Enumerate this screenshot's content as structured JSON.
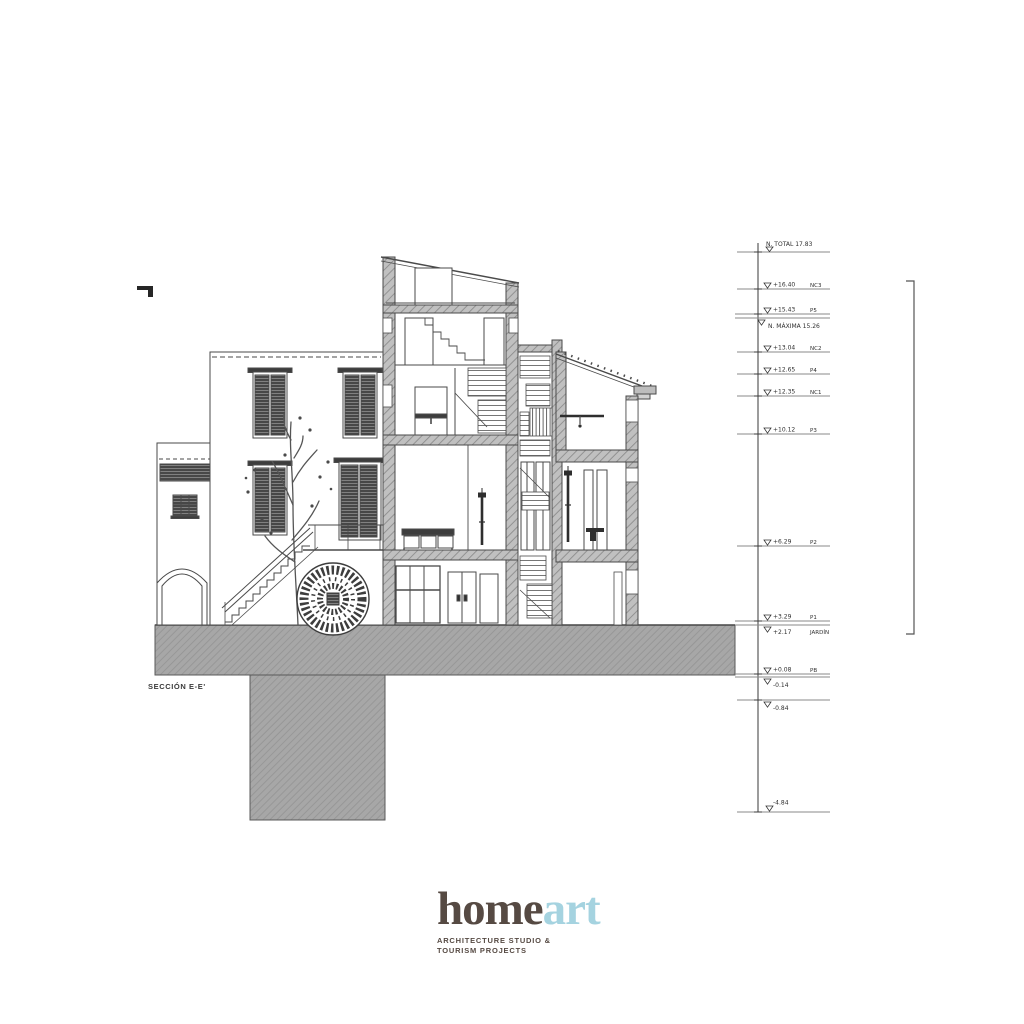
{
  "drawing": {
    "section_label": "SECCIÓN E-E'"
  },
  "levels": {
    "total_label": "N. TOTAL 17.83",
    "maxima_label": "N. MÁXIMA 15.26",
    "items": [
      {
        "elev": "+16.40",
        "tag": "NC3"
      },
      {
        "elev": "+15.43",
        "tag": "P5"
      },
      {
        "elev": "+13.04",
        "tag": "NC2"
      },
      {
        "elev": "+12.65",
        "tag": "P4"
      },
      {
        "elev": "+12.35",
        "tag": "NC1"
      },
      {
        "elev": "+10.12",
        "tag": "P3"
      },
      {
        "elev": "+6.29",
        "tag": "P2"
      },
      {
        "elev": "+3.29",
        "tag": "P1"
      },
      {
        "elev": "+2.17",
        "tag": "JARDÍN"
      },
      {
        "elev": "+0.08",
        "tag": "PB"
      },
      {
        "elev": "-0.14",
        "tag": ""
      },
      {
        "elev": "-0.84",
        "tag": ""
      },
      {
        "elev": "-4.84",
        "tag": ""
      }
    ]
  },
  "logo": {
    "word_primary": "home",
    "word_accent": "art",
    "subtitle_line1": "ARCHITECTURE STUDIO &",
    "subtitle_line2": "TOURISM PROJECTS",
    "colors": {
      "primary": "#564a43",
      "accent": "#a5d3e0"
    }
  }
}
